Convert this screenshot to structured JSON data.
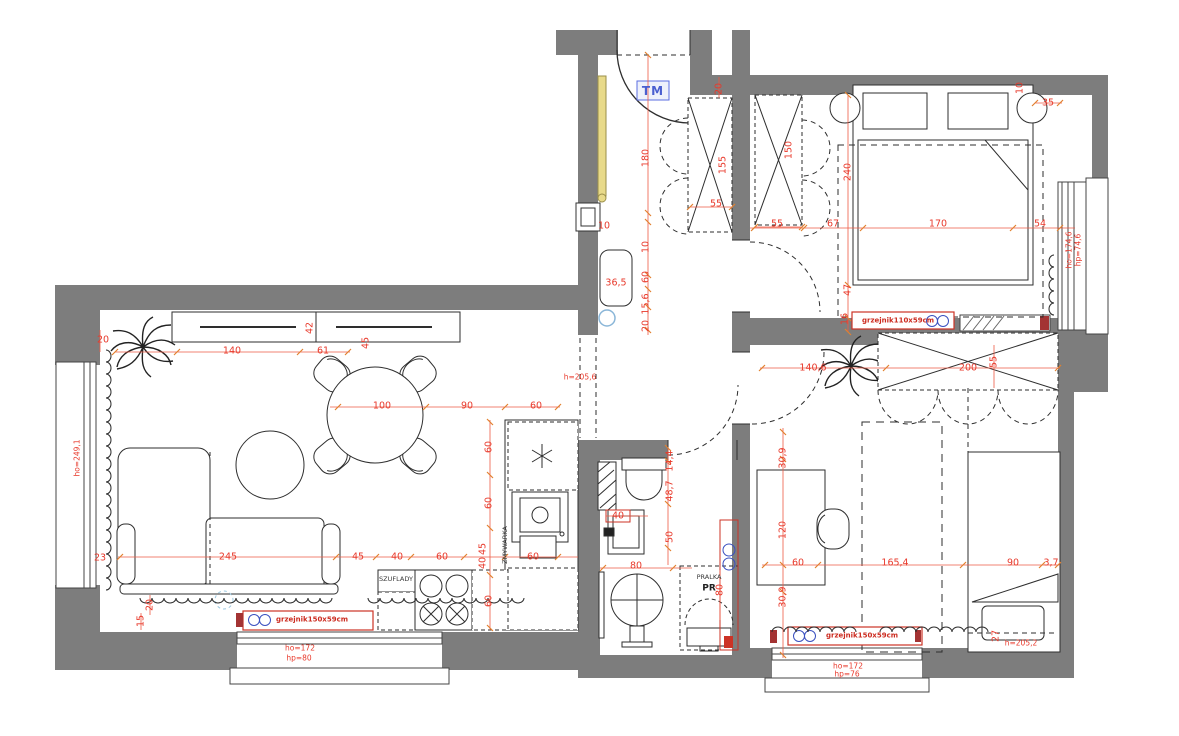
{
  "colors": {
    "wall_gray": "#7d7d7d",
    "dimension_red": "#e8392b",
    "dimension_line": "#ee5a45",
    "tick_orange": "#e2812f",
    "radiator_red": "#cc3326",
    "accent_blue": "#4a5fd0",
    "valve_blue": "#3a50c0",
    "highlight_yellow": "#e8da8a",
    "line_black": "#2e2e2e",
    "background": "#ffffff"
  },
  "annotations": [
    {
      "t": "20",
      "x": 103,
      "y": 340
    },
    {
      "t": "140",
      "x": 232,
      "y": 351
    },
    {
      "t": "61",
      "x": 323,
      "y": 351
    },
    {
      "t": "42",
      "x": 310,
      "y": 328,
      "r": -90
    },
    {
      "t": "45",
      "x": 366,
      "y": 343,
      "r": -90
    },
    {
      "t": "100",
      "x": 382,
      "y": 406
    },
    {
      "t": "90",
      "x": 467,
      "y": 406
    },
    {
      "t": "60",
      "x": 536,
      "y": 406
    },
    {
      "t": "245",
      "x": 228,
      "y": 557
    },
    {
      "t": "45",
      "x": 358,
      "y": 557
    },
    {
      "t": "40",
      "x": 397,
      "y": 557
    },
    {
      "t": "60",
      "x": 442,
      "y": 557
    },
    {
      "t": "45",
      "x": 483,
      "y": 549,
      "r": -90
    },
    {
      "t": "40",
      "x": 483,
      "y": 563,
      "r": -90
    },
    {
      "t": "60",
      "x": 533,
      "y": 557
    },
    {
      "t": "60",
      "x": 489,
      "y": 447,
      "r": -90
    },
    {
      "t": "60",
      "x": 489,
      "y": 503,
      "r": -90
    },
    {
      "t": "60",
      "x": 489,
      "y": 601,
      "r": -90
    },
    {
      "t": "23",
      "x": 100,
      "y": 558
    },
    {
      "t": "20",
      "x": 150,
      "y": 605,
      "r": -90
    },
    {
      "t": "15",
      "x": 141,
      "y": 621,
      "r": -90
    },
    {
      "t": "180",
      "x": 646,
      "y": 158,
      "r": -90
    },
    {
      "t": "10",
      "x": 646,
      "y": 247,
      "r": -90
    },
    {
      "t": "60",
      "x": 646,
      "y": 277,
      "r": -90
    },
    {
      "t": "15,6",
      "x": 646,
      "y": 304,
      "r": -90
    },
    {
      "t": "20",
      "x": 646,
      "y": 326,
      "r": -90
    },
    {
      "t": "36,5",
      "x": 616,
      "y": 283
    },
    {
      "t": "10",
      "x": 604,
      "y": 226
    },
    {
      "t": "20",
      "x": 719,
      "y": 89,
      "r": -90
    },
    {
      "t": "155",
      "x": 723,
      "y": 165,
      "r": -90
    },
    {
      "t": "55",
      "x": 716,
      "y": 204
    },
    {
      "t": "150",
      "x": 789,
      "y": 150,
      "r": -90
    },
    {
      "t": "55",
      "x": 777,
      "y": 224
    },
    {
      "t": "67",
      "x": 833,
      "y": 224
    },
    {
      "t": "170",
      "x": 938,
      "y": 224
    },
    {
      "t": "54",
      "x": 1040,
      "y": 224
    },
    {
      "t": "240",
      "x": 848,
      "y": 172,
      "r": -90
    },
    {
      "t": "47",
      "x": 848,
      "y": 290,
      "r": -90
    },
    {
      "t": "16",
      "x": 845,
      "y": 319,
      "r": -90
    },
    {
      "t": "35",
      "x": 1048,
      "y": 103
    },
    {
      "t": "10",
      "x": 1020,
      "y": 88,
      "r": -90
    },
    {
      "t": "14,4",
      "x": 670,
      "y": 461,
      "r": -90
    },
    {
      "t": "48,7",
      "x": 670,
      "y": 491,
      "r": -90
    },
    {
      "t": "40",
      "x": 618,
      "y": 516
    },
    {
      "t": "50",
      "x": 670,
      "y": 537,
      "r": -90
    },
    {
      "t": "80",
      "x": 636,
      "y": 566
    },
    {
      "t": "80",
      "x": 720,
      "y": 590,
      "r": -90
    },
    {
      "t": "140,6",
      "x": 813,
      "y": 368
    },
    {
      "t": "200",
      "x": 968,
      "y": 368
    },
    {
      "t": "55",
      "x": 994,
      "y": 362,
      "r": -90
    },
    {
      "t": "30,9",
      "x": 783,
      "y": 458,
      "r": -90
    },
    {
      "t": "120",
      "x": 783,
      "y": 530,
      "r": -90
    },
    {
      "t": "30,9",
      "x": 783,
      "y": 597,
      "r": -90
    },
    {
      "t": "60",
      "x": 798,
      "y": 563
    },
    {
      "t": "165,4",
      "x": 895,
      "y": 563
    },
    {
      "t": "90",
      "x": 1013,
      "y": 563
    },
    {
      "t": "3,7",
      "x": 1051,
      "y": 563
    },
    {
      "t": "27",
      "x": 996,
      "y": 636,
      "r": -90
    },
    {
      "t": "h=205,2",
      "x": 1021,
      "y": 643,
      "c": "s"
    },
    {
      "t": "h=205,6",
      "x": 580,
      "y": 377,
      "c": "s"
    },
    {
      "t": "ho=249,1",
      "x": 77,
      "y": 458,
      "r": -90,
      "c": "s"
    },
    {
      "t": "ho=174,6",
      "x": 1069,
      "y": 250,
      "r": -90,
      "c": "s"
    },
    {
      "t": "hp=74,6",
      "x": 1078,
      "y": 250,
      "r": -90,
      "c": "s"
    },
    {
      "t": "ho=172",
      "x": 300,
      "y": 648,
      "c": "s"
    },
    {
      "t": "hp=80",
      "x": 299,
      "y": 658,
      "c": "s"
    },
    {
      "t": "ho=172",
      "x": 848,
      "y": 666,
      "c": "s"
    },
    {
      "t": "hp=76",
      "x": 847,
      "y": 674,
      "c": "s"
    },
    {
      "t": "TM",
      "x": 653,
      "y": 91,
      "c": "tm"
    },
    {
      "t": "SZUFLADY",
      "x": 396,
      "y": 579,
      "c": "k"
    },
    {
      "t": "ZMYWARKA",
      "x": 505,
      "y": 545,
      "r": -90,
      "c": "k"
    },
    {
      "t": "PRALKA",
      "x": 709,
      "y": 577,
      "c": "k"
    },
    {
      "t": "PR",
      "x": 709,
      "y": 589,
      "c": "pr"
    },
    {
      "t": "grzejnik150x59cm",
      "x": 312,
      "y": 620,
      "c": "r"
    },
    {
      "t": "grzejnik110x59cm",
      "x": 898,
      "y": 321,
      "c": "r"
    },
    {
      "t": "grzejnik150x59cm",
      "x": 862,
      "y": 636,
      "c": "r"
    }
  ]
}
